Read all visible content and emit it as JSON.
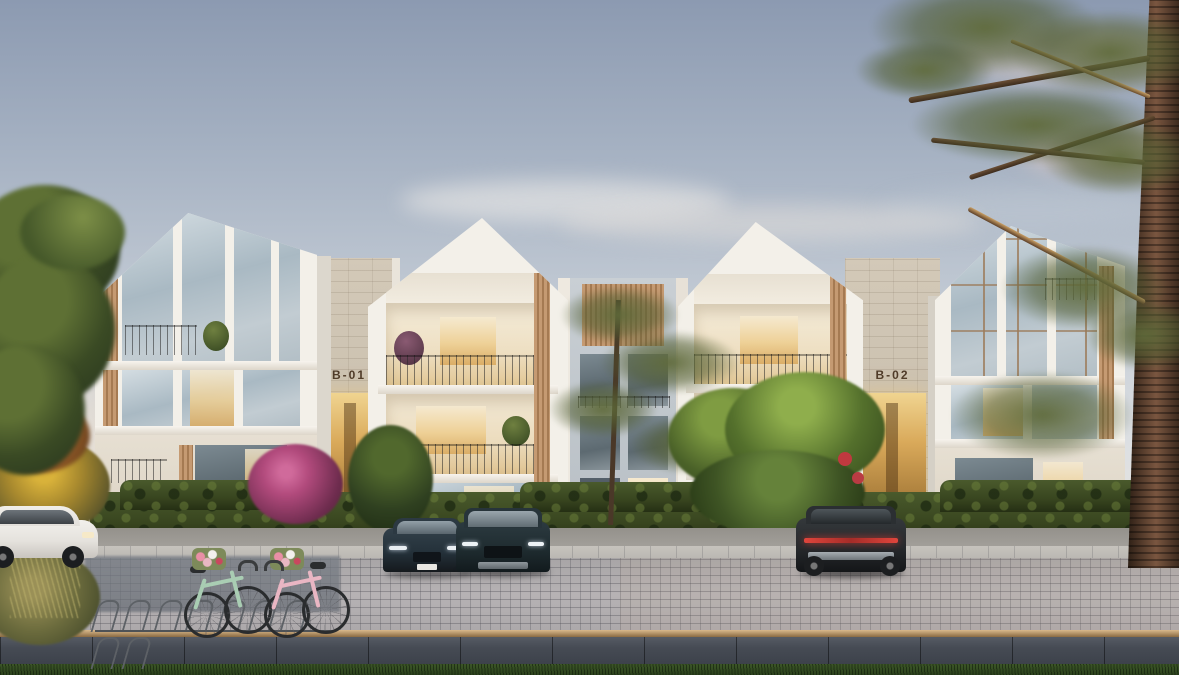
{
  "scene": {
    "title": "Residential complex exterior rendering at dusk",
    "signs": {
      "left_block": "B-01",
      "right_block": "B-02"
    },
    "architecture": {
      "gabled_modules": 4,
      "stone_entry_blocks": 2,
      "lit_interiors": true,
      "materials": [
        "white stucco",
        "limestone",
        "wood slats",
        "glass"
      ]
    },
    "palette": {
      "sky_top": "#8c9ab1",
      "sky_horizon": "#ece7e0",
      "cloud_pink": "#eed7c9",
      "facade_white": "#f3f0e9",
      "stucco": "#e2dacc",
      "stone": "#cbc1b0",
      "wood": "#bb8f66",
      "glass_cool": "#a9b9c3",
      "window_warm": "#eecf92",
      "hedge": "#3a4526",
      "pine_olive": "#5a6437",
      "paver": "#b3afb1",
      "sidewalk": "#4a4f58",
      "grass": "#35512a",
      "car_dark": "#28343a",
      "car_white": "#e9e7e3",
      "taillight_red": "#d43a35",
      "bike_mint": "#a9cdb3",
      "bike_pink": "#e9b6c3",
      "brass_edge": "#b08a58"
    },
    "vehicles": [
      {
        "name": "white-hatchback",
        "position": "far-left",
        "color": "white"
      },
      {
        "name": "dark-sedan",
        "position": "center-left",
        "color": "dark-teal"
      },
      {
        "name": "dark-suv-front",
        "position": "center",
        "color": "dark-teal"
      },
      {
        "name": "dark-suv-rear",
        "position": "right",
        "color": "charcoal"
      }
    ],
    "bicycles": [
      {
        "name": "mint-bicycle",
        "basket": "flowers"
      },
      {
        "name": "pink-bicycle",
        "basket": "flowers"
      }
    ],
    "landscape": [
      "left-broadleaf-tree",
      "center-pine-tree",
      "flowering-green-tree",
      "large-pine-tree-right",
      "hedgerow",
      "bougainvillea",
      "yellow-flower-bush",
      "ornamental-grasses",
      "bike-rack"
    ]
  }
}
